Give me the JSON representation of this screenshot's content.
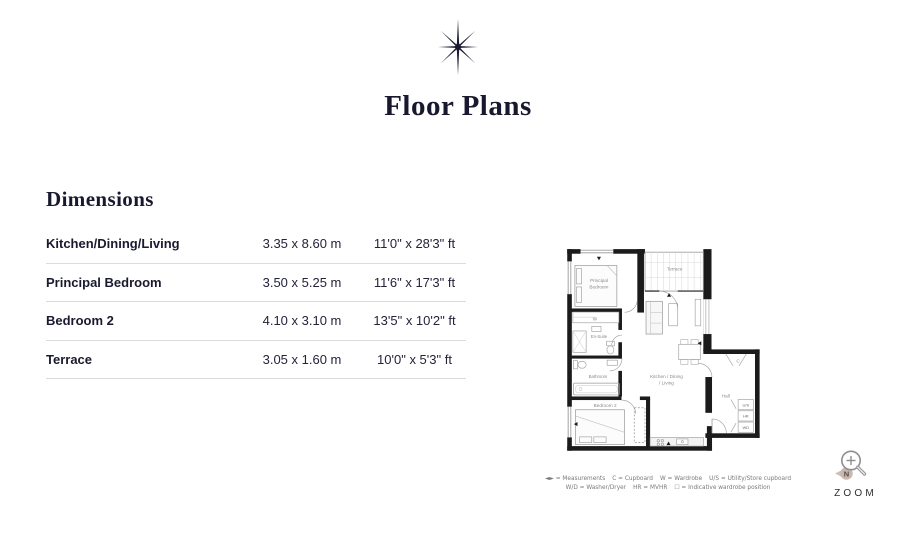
{
  "header": {
    "title": "Floor Plans",
    "section_heading": "Dimensions"
  },
  "dimensions_table": {
    "rows": [
      {
        "room": "Kitchen/Dining/Living",
        "metric": "3.35 x 8.60 m",
        "imperial": "11'0\" x 28'3\" ft"
      },
      {
        "room": "Principal Bedroom",
        "metric": "3.50 x 5.25 m",
        "imperial": "11'6\" x 17'3\" ft"
      },
      {
        "room": "Bedroom 2",
        "metric": "4.10 x 3.10 m",
        "imperial": "13'5\" x 10'2\" ft"
      },
      {
        "room": "Terrace",
        "metric": "3.05 x 1.60 m",
        "imperial": "10'0\" x 5'3\" ft"
      }
    ]
  },
  "floorplan": {
    "rooms": {
      "principal_l1": "Principal",
      "principal_l2": "Bedroom",
      "terrace": "Terrace",
      "wardrobe": "W",
      "ensuite": "En-Suite",
      "bathroom": "Bathroom",
      "bedroom2": "Bedroom 2",
      "kitchen_l1": "Kitchen / Dining",
      "kitchen_l2": "/ Living",
      "hall": "Hall",
      "cupboard": "C",
      "utility_store": "U/S",
      "heat_recovery": "HR",
      "washer_dryer": "WD"
    },
    "legend1": [
      "◄► = Measurements",
      "C = Cupboard",
      "W = Wardrobe",
      "U/S = Utility/Store cupboard"
    ],
    "legend2": [
      "W/D = Washer/Dryer",
      "HR = MVHR",
      "☐ = Indicative wardrobe position"
    ]
  },
  "zoom_control": {
    "label": "ZOOM",
    "compass": "N"
  },
  "colors": {
    "text_dark": "#18182e",
    "wall": "#1b1b1b",
    "plan_grey": "#9a9a9a",
    "compass_tan": "#c9b8ae"
  }
}
